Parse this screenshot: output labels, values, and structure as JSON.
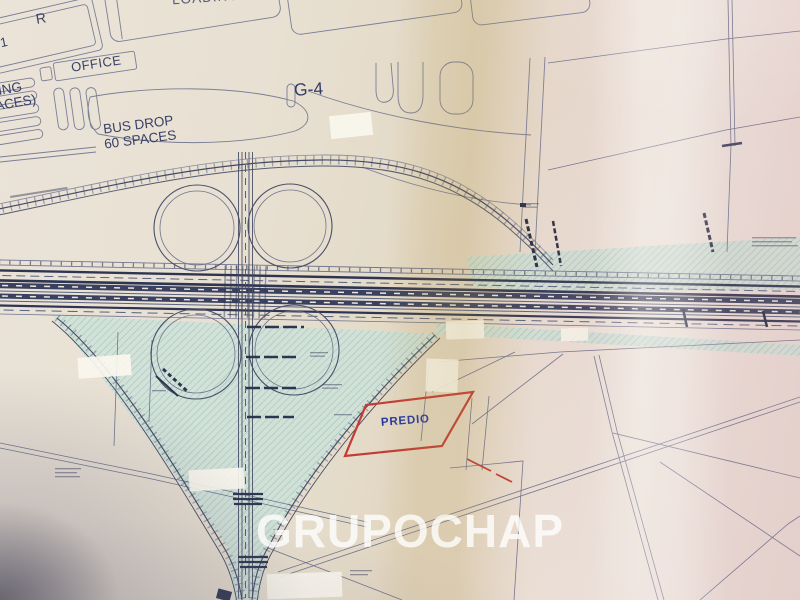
{
  "plan": {
    "labels": {
      "loading": "LOADING",
      "parcel_r": "R",
      "parcel_g1": "-1",
      "office": "OFFICE",
      "parking_fragment_line1": "ING",
      "parking_fragment_line2": "ACES)",
      "bus_drop_line1": "BUS DROP",
      "bus_drop_line2": "60 SPACES",
      "g4": "G-4",
      "predio": "PREDIO"
    },
    "watermark": "GRUPOCHAP",
    "colors": {
      "paper": "#e8dfd0",
      "teal_fill": "#cde2da",
      "teal_hatch": "#8cbcb2",
      "line_thin": "#6f7390",
      "line_dark": "#2e3550",
      "parcel_red": "#c23b34",
      "predio_text": "#2336a0",
      "label_text": "#3a4166",
      "watermark_text": "#ffffff"
    }
  }
}
